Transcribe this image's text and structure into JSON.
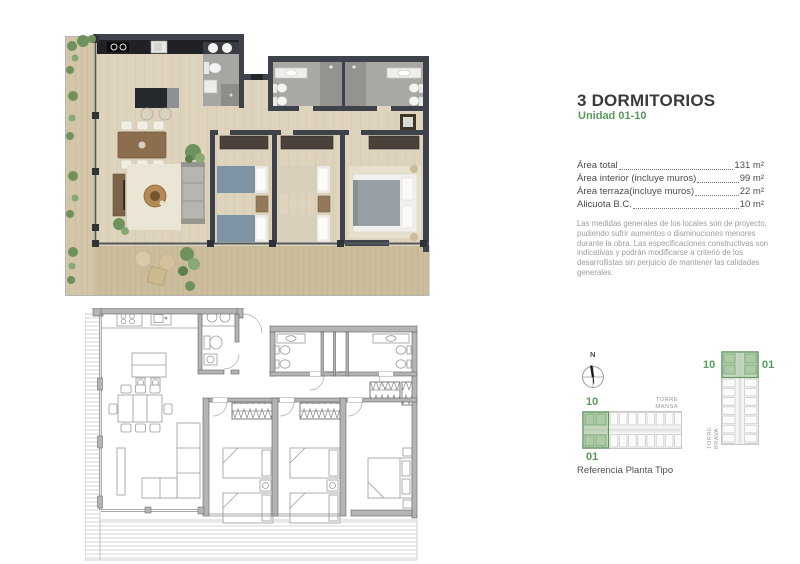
{
  "header": {
    "title": "3 DORMITORIOS",
    "unit": "Unidad 01-10"
  },
  "areas": {
    "rows": [
      {
        "label": "Área total",
        "value": "131 m²"
      },
      {
        "label": "Área interior (incluye muros)",
        "value": "99 m²"
      },
      {
        "label": "Área terraza(incluye muros)",
        "value": "22 m²"
      },
      {
        "label": "Alicuota B.C.",
        "value": "10 m²"
      }
    ]
  },
  "disclaimer": "Las medidas generales de los locales son de proyecto, pudiendo sufrir aumentos o disminuciones menores durante la obra. Las especificaciones constructivas son indicativas y podrán modificarse a criterio de los desarrollistas sin perjuicio de mantener las calidades generales.",
  "compass": {
    "north": "N"
  },
  "reference": {
    "caption": "Referencia Planta Tipo",
    "torre_mansa": {
      "name": "TORRE MANSA",
      "label_top": "10",
      "label_bottom": "01"
    },
    "torre_brava": {
      "name": "TORRE BRAVA",
      "label_left": "10",
      "label_right": "01"
    }
  },
  "colors": {
    "accent_green": "#58995c",
    "highlight_green": "#9dc096",
    "title_text": "#3b3b3b",
    "body_text": "#4c4c4c",
    "muted_text": "#9c9c9c",
    "wall_dark": "#3e434b",
    "floor_wood": "#ded3bd",
    "terrace_wood": "#cdbd9d",
    "bath_gray": "#a7a6a2",
    "plan_line_gray": "#9a9a9a"
  }
}
